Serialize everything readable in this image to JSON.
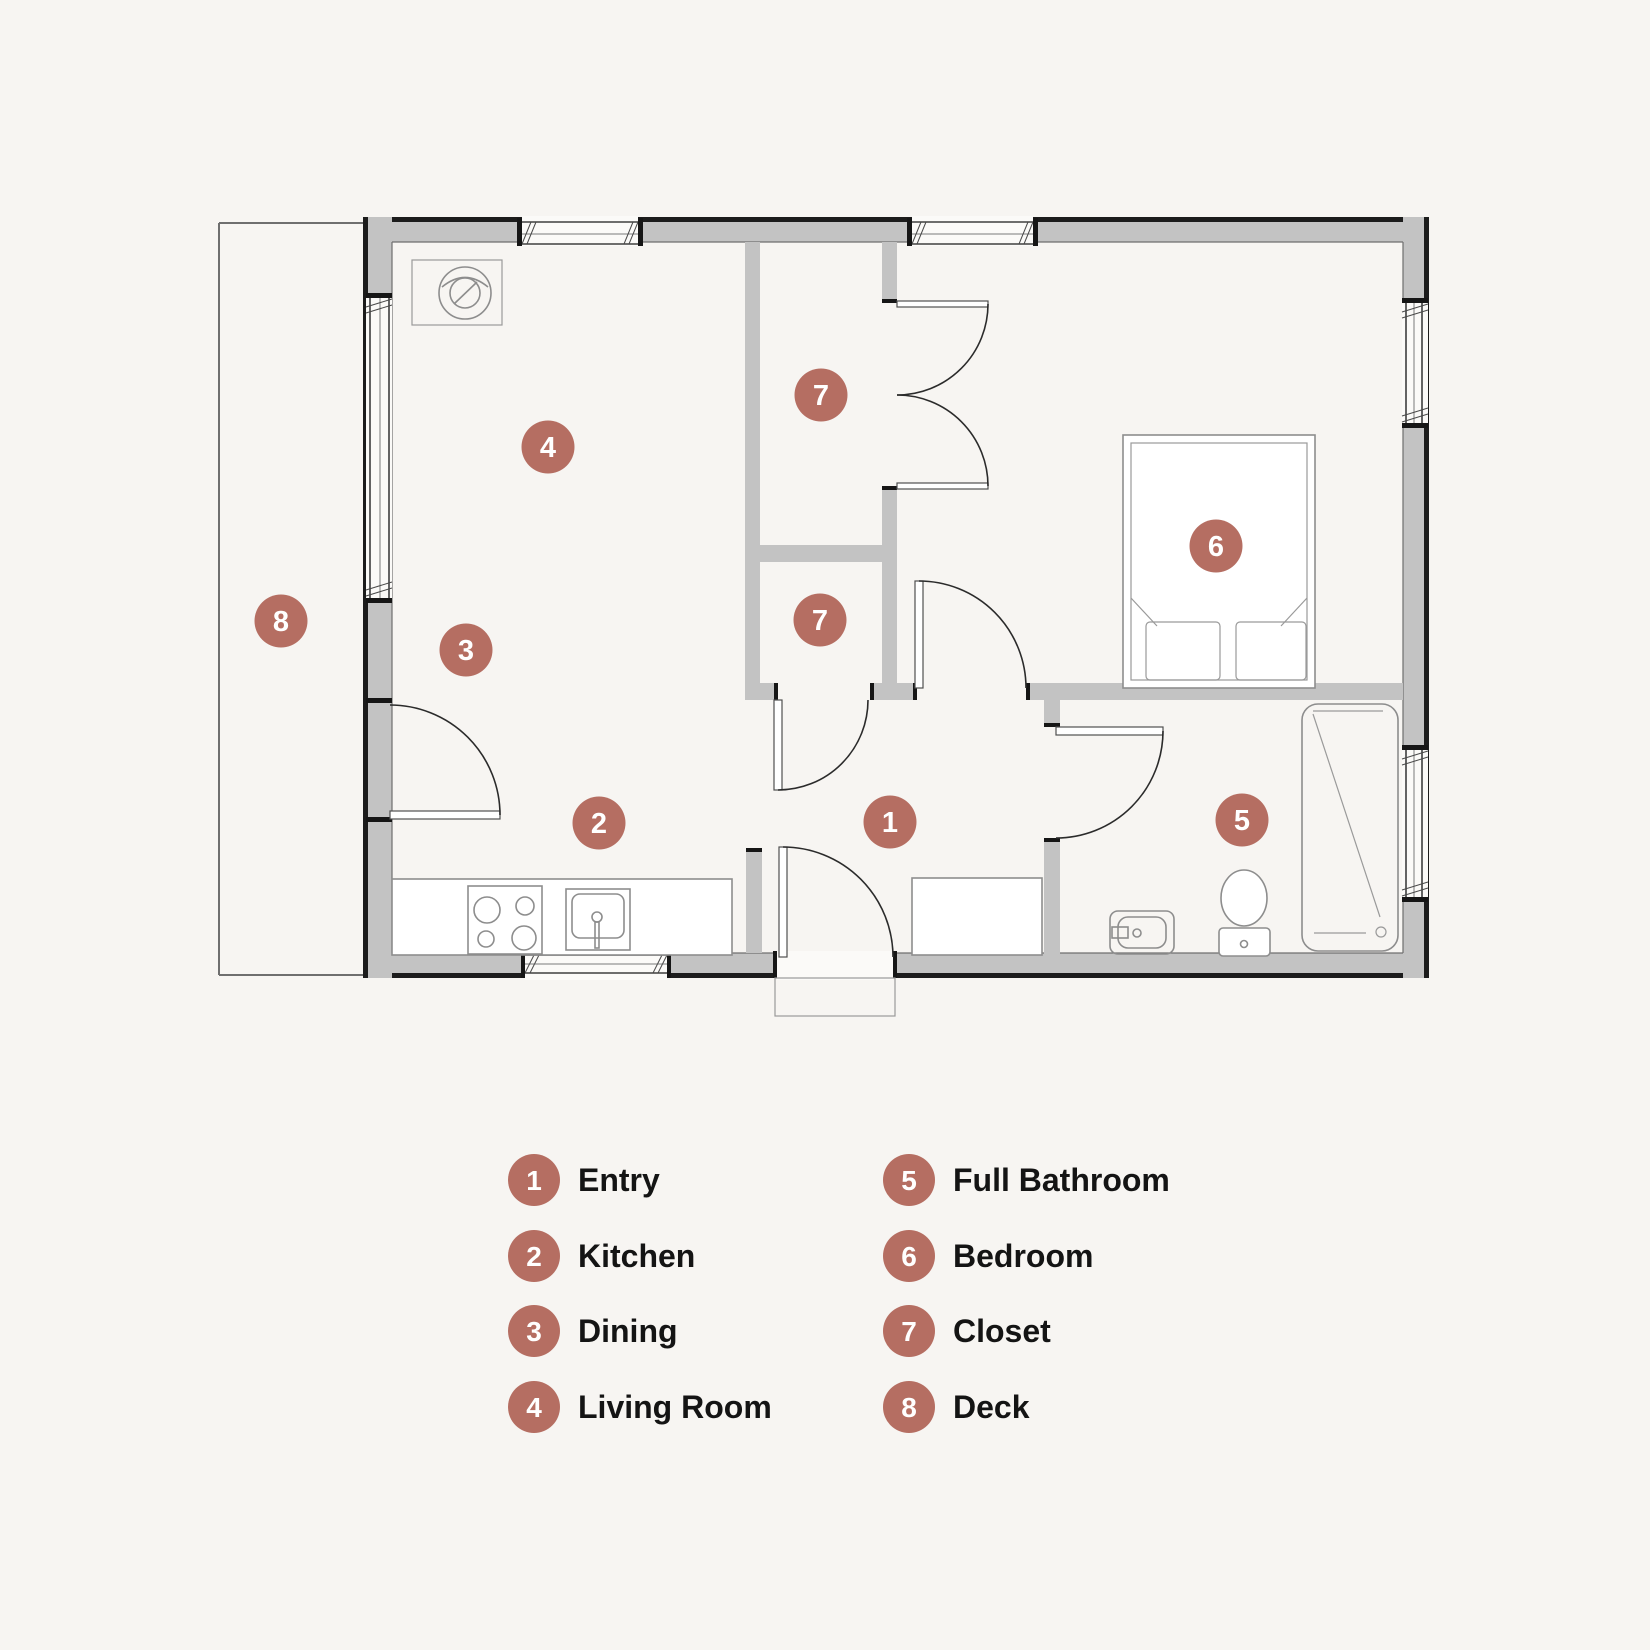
{
  "title": "One-bedroom cottage floor plan",
  "colors": {
    "background": "#f7f5f2",
    "marker": "#b56e62",
    "wall_fill": "#c3c3c3",
    "wall_edge": "#1c1c1c",
    "fixture_line": "#8d8d8d"
  },
  "plan": {
    "markers": [
      {
        "number": "1",
        "room": "Entry",
        "x": 890,
        "y": 822
      },
      {
        "number": "2",
        "room": "Kitchen",
        "x": 599,
        "y": 823
      },
      {
        "number": "3",
        "room": "Dining",
        "x": 466,
        "y": 650
      },
      {
        "number": "4",
        "room": "Living Room",
        "x": 548,
        "y": 447
      },
      {
        "number": "5",
        "room": "Full Bathroom",
        "x": 1242,
        "y": 820
      },
      {
        "number": "6",
        "room": "Bedroom",
        "x": 1216,
        "y": 546
      },
      {
        "number": "7",
        "room": "Closet",
        "x": 821,
        "y": 395
      },
      {
        "number": "7",
        "room": "Closet",
        "x": 820,
        "y": 620
      },
      {
        "number": "8",
        "room": "Deck",
        "x": 281,
        "y": 621
      }
    ]
  },
  "legend": {
    "columns": [
      {
        "items": [
          {
            "number": "1",
            "label": "Entry"
          },
          {
            "number": "2",
            "label": "Kitchen"
          },
          {
            "number": "3",
            "label": "Dining"
          },
          {
            "number": "4",
            "label": "Living Room"
          }
        ]
      },
      {
        "items": [
          {
            "number": "5",
            "label": "Full Bathroom"
          },
          {
            "number": "6",
            "label": "Bedroom"
          },
          {
            "number": "7",
            "label": "Closet"
          },
          {
            "number": "8",
            "label": "Deck"
          }
        ]
      }
    ],
    "layout": {
      "col_x": [
        534,
        909
      ],
      "row_y": [
        1180,
        1256,
        1331,
        1407
      ],
      "circle_r": 26,
      "text_dx": 44
    }
  }
}
